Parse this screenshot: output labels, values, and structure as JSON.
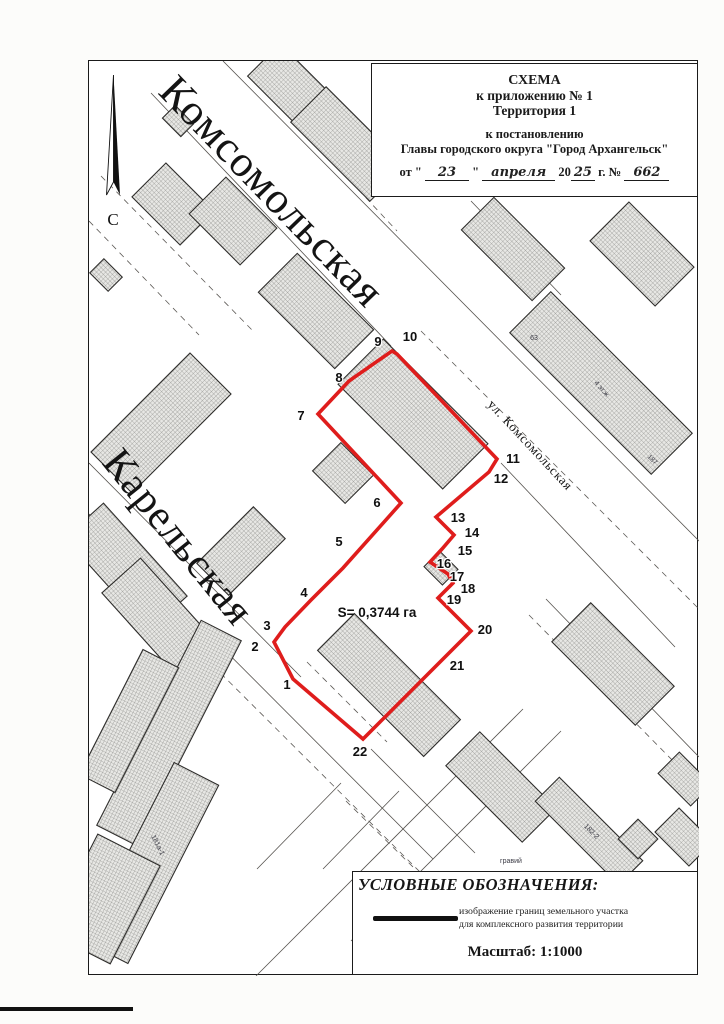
{
  "title_block": {
    "line1": "СХЕМА",
    "line2": "к приложению № 1",
    "line3": "Территория 1",
    "line4": "к постановлению",
    "line5": "Главы городского округа \"Город Архангельск\"",
    "date_prefix": "от \"",
    "date_day": "23",
    "date_quote": "\"",
    "date_month": "апреля",
    "date_year_prefix": "20",
    "date_year": "25",
    "date_g": "г. №",
    "doc_number": "662"
  },
  "legend": {
    "heading": "УСЛОВНЫЕ ОБОЗНАЧЕНИЯ:",
    "item_desc_line1": "изображение границ земельного участка",
    "item_desc_line2": "для комплексного развития территории",
    "scale_label": "Масштаб: 1:1000"
  },
  "north_label": "С",
  "map": {
    "boundary_color": "#df1d1c",
    "area_label": {
      "text": "S= 0,3744 га",
      "x": 376,
      "y": 616
    },
    "street_labels": [
      {
        "text": "Комсомольская",
        "x": 156,
        "y": 92,
        "rot": 46,
        "size": 44,
        "kind": "big"
      },
      {
        "text": "Карельская",
        "x": 100,
        "y": 462,
        "rot": 51,
        "size": 42,
        "kind": "big"
      },
      {
        "text": "ул. Комсомольская",
        "x": 486,
        "y": 404,
        "rot": 47,
        "size": 13,
        "kind": "small"
      }
    ],
    "boundary_vertices": [
      [
        292,
        678
      ],
      [
        273,
        641
      ],
      [
        284,
        626
      ],
      [
        310,
        599
      ],
      [
        342,
        567
      ],
      [
        400,
        502
      ],
      [
        317,
        413
      ],
      [
        348,
        380
      ],
      [
        391,
        350
      ],
      [
        396,
        353
      ],
      [
        496,
        458
      ],
      [
        488,
        471
      ],
      [
        435,
        516
      ],
      [
        453,
        534
      ],
      [
        441,
        548
      ],
      [
        429,
        561
      ],
      [
        447,
        573
      ],
      [
        452,
        582
      ],
      [
        437,
        597
      ],
      [
        470,
        630
      ],
      [
        448,
        652
      ],
      [
        362,
        738
      ]
    ],
    "point_labels": [
      {
        "n": "1",
        "x": 286,
        "y": 684
      },
      {
        "n": "2",
        "x": 254,
        "y": 646
      },
      {
        "n": "3",
        "x": 266,
        "y": 625
      },
      {
        "n": "4",
        "x": 303,
        "y": 592
      },
      {
        "n": "5",
        "x": 338,
        "y": 541
      },
      {
        "n": "6",
        "x": 376,
        "y": 502
      },
      {
        "n": "7",
        "x": 300,
        "y": 415
      },
      {
        "n": "8",
        "x": 338,
        "y": 377
      },
      {
        "n": "9",
        "x": 377,
        "y": 341
      },
      {
        "n": "10",
        "x": 409,
        "y": 336
      },
      {
        "n": "11",
        "x": 512,
        "y": 458
      },
      {
        "n": "12",
        "x": 500,
        "y": 478
      },
      {
        "n": "13",
        "x": 457,
        "y": 517
      },
      {
        "n": "14",
        "x": 471,
        "y": 532
      },
      {
        "n": "15",
        "x": 464,
        "y": 550
      },
      {
        "n": "16",
        "x": 443,
        "y": 563
      },
      {
        "n": "17",
        "x": 456,
        "y": 576
      },
      {
        "n": "18",
        "x": 467,
        "y": 588
      },
      {
        "n": "19",
        "x": 453,
        "y": 599
      },
      {
        "n": "20",
        "x": 484,
        "y": 629
      },
      {
        "n": "21",
        "x": 456,
        "y": 665
      },
      {
        "n": "22",
        "x": 359,
        "y": 751
      }
    ],
    "buildings": [
      {
        "cx": 300,
        "cy": 96,
        "w": 105,
        "h": 46,
        "rot": 45
      },
      {
        "cx": 347,
        "cy": 143,
        "w": 112,
        "h": 50,
        "rot": 45
      },
      {
        "cx": 172,
        "cy": 203,
        "w": 68,
        "h": 48,
        "rot": 45
      },
      {
        "cx": 232,
        "cy": 220,
        "w": 72,
        "h": 52,
        "rot": 45
      },
      {
        "cx": 105,
        "cy": 274,
        "w": 26,
        "h": 20,
        "rot": 45
      },
      {
        "cx": 177,
        "cy": 120,
        "w": 26,
        "h": 18,
        "rot": 45
      },
      {
        "cx": 417,
        "cy": 103,
        "w": 30,
        "h": 22,
        "rot": 45
      },
      {
        "cx": 448,
        "cy": 140,
        "w": 28,
        "h": 20,
        "rot": 45
      },
      {
        "cx": 160,
        "cy": 422,
        "w": 140,
        "h": 58,
        "rot": -45
      },
      {
        "cx": 240,
        "cy": 550,
        "w": 80,
        "h": 45,
        "rot": -45
      },
      {
        "cx": 125,
        "cy": 566,
        "w": 125,
        "h": 52,
        "rot": 48
      },
      {
        "cx": 162,
        "cy": 621,
        "w": 125,
        "h": 52,
        "rot": 48
      },
      {
        "cx": 315,
        "cy": 310,
        "w": 108,
        "h": 55,
        "rot": 45
      },
      {
        "cx": 168,
        "cy": 732,
        "w": 230,
        "h": 45,
        "rot": 117
      },
      {
        "cx": 128,
        "cy": 720,
        "w": 140,
        "h": 40,
        "rot": 117
      },
      {
        "cx": 150,
        "cy": 862,
        "w": 200,
        "h": 50,
        "rot": 117
      },
      {
        "cx": 103,
        "cy": 898,
        "w": 110,
        "h": 70,
        "rot": 117
      },
      {
        "cx": 512,
        "cy": 248,
        "w": 100,
        "h": 46,
        "rot": 45
      },
      {
        "cx": 641,
        "cy": 253,
        "w": 92,
        "h": 55,
        "rot": 45
      },
      {
        "cx": 600,
        "cy": 382,
        "w": 200,
        "h": 58,
        "rot": 45
      },
      {
        "cx": 612,
        "cy": 663,
        "w": 118,
        "h": 55,
        "rot": 45
      },
      {
        "cx": 500,
        "cy": 786,
        "w": 108,
        "h": 48,
        "rot": 45
      },
      {
        "cx": 588,
        "cy": 830,
        "w": 118,
        "h": 34,
        "rot": 45
      },
      {
        "cx": 637,
        "cy": 838,
        "w": 28,
        "h": 28,
        "rot": 45
      },
      {
        "cx": 684,
        "cy": 778,
        "w": 46,
        "h": 30,
        "rot": 45
      },
      {
        "cx": 683,
        "cy": 836,
        "w": 48,
        "h": 34,
        "rot": 45
      },
      {
        "cx": 412,
        "cy": 413,
        "w": 148,
        "h": 64,
        "rot": 45
      },
      {
        "cx": 342,
        "cy": 472,
        "w": 46,
        "h": 40,
        "rot": 45
      },
      {
        "cx": 388,
        "cy": 684,
        "w": 150,
        "h": 52,
        "rot": 45
      },
      {
        "cx": 440,
        "cy": 567,
        "w": 26,
        "h": 22,
        "rot": 45
      }
    ],
    "building_labels": [
      {
        "text": "63",
        "x": 533,
        "y": 339,
        "rot": 0,
        "size": 7
      },
      {
        "text": "187",
        "x": 650,
        "y": 460,
        "rot": 45,
        "size": 6.5
      },
      {
        "text": "4 эт.ж",
        "x": 599,
        "y": 389,
        "rot": 48,
        "size": 7
      },
      {
        "text": "181а-1",
        "x": 155,
        "y": 845,
        "rot": 63,
        "size": 7
      },
      {
        "text": "182-2",
        "x": 589,
        "y": 832,
        "rot": 45,
        "size": 7
      },
      {
        "text": "гравий",
        "x": 510,
        "y": 862,
        "rot": 0,
        "size": 7
      }
    ],
    "roads_solid": [
      [
        150,
        92,
        390,
        345
      ],
      [
        500,
        462,
        674,
        646
      ],
      [
        222,
        60,
        700,
        542
      ],
      [
        88,
        462,
        300,
        676
      ],
      [
        370,
        748,
        474,
        852
      ],
      [
        88,
        513,
        432,
        858
      ],
      [
        255,
        975,
        522,
        708
      ],
      [
        350,
        940,
        560,
        730
      ],
      [
        545,
        598,
        698,
        756
      ],
      [
        470,
        200,
        560,
        294
      ],
      [
        340,
        782,
        256,
        868
      ],
      [
        398,
        790,
        322,
        868
      ]
    ],
    "roads_dashed": [
      [
        420,
        330,
        698,
        608
      ],
      [
        252,
        76,
        396,
        230
      ],
      [
        95,
        548,
        420,
        872
      ],
      [
        528,
        614,
        680,
        768
      ],
      [
        100,
        175,
        252,
        330
      ],
      [
        88,
        220,
        198,
        334
      ],
      [
        318,
        648,
        398,
        728
      ],
      [
        306,
        661,
        386,
        741
      ],
      [
        345,
        800,
        412,
        866
      ]
    ]
  }
}
